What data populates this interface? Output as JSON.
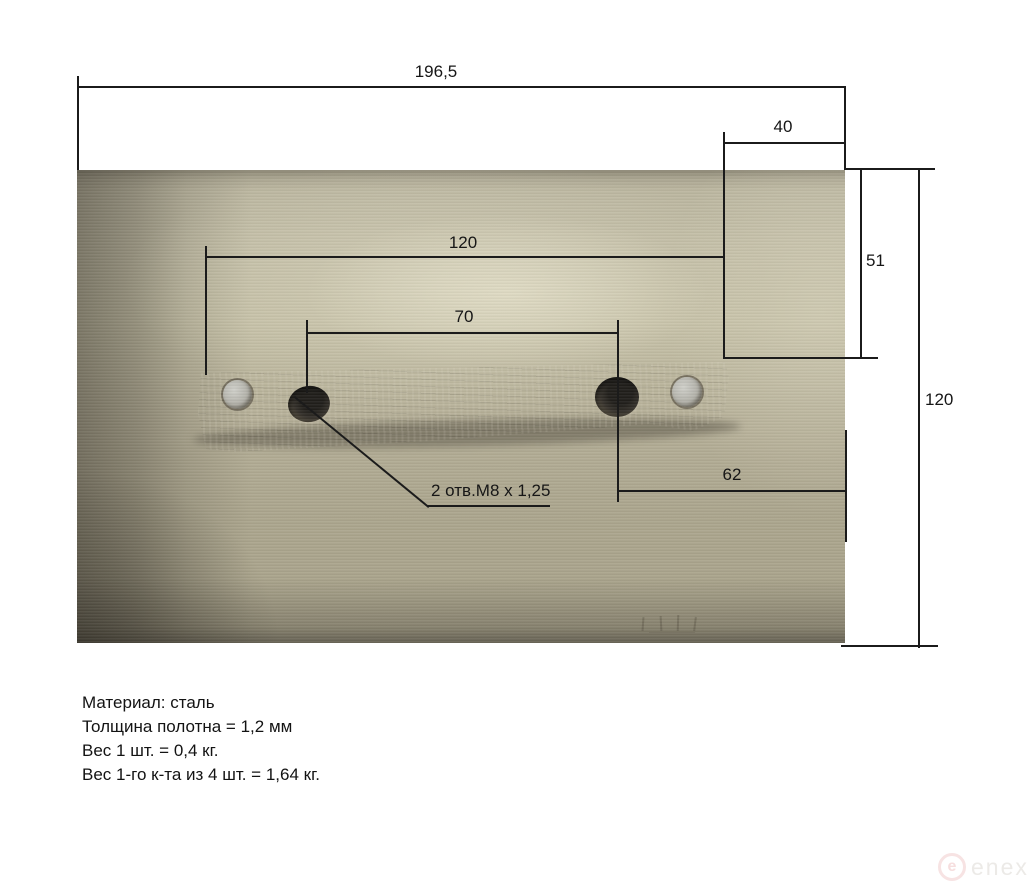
{
  "page": {
    "background_color": "#ffffff",
    "line_color": "#1b1b1b"
  },
  "drawing": {
    "dimensions": {
      "overall_width": "196,5",
      "top_right_offset": "40",
      "right_upper_height": "51",
      "overall_height": "120",
      "mount_bar_span": "120",
      "hole_spacing": "70",
      "lower_right_offset": "62",
      "holes_note": "2 отв.М8 х 1,25"
    },
    "notes": [
      "Материал: сталь",
      "Толщина полотна = 1,2 мм",
      "Вес 1 шт. = 0,4 кг.",
      "Вес 1-го к-та из 4 шт. = 1,64 кг."
    ],
    "photo_colors": {
      "plate_light": "#c4bfa5",
      "plate_base": "#b1ab92",
      "plate_shadow": "#6e6958",
      "bar": "#7c7362",
      "hole": "#2b2823",
      "rivet": "#b2b1a9"
    },
    "watermark": {
      "logo_letter": "e",
      "text": "enex",
      "logo_color": "#f7e3e3",
      "text_color": "#eceae7"
    }
  }
}
